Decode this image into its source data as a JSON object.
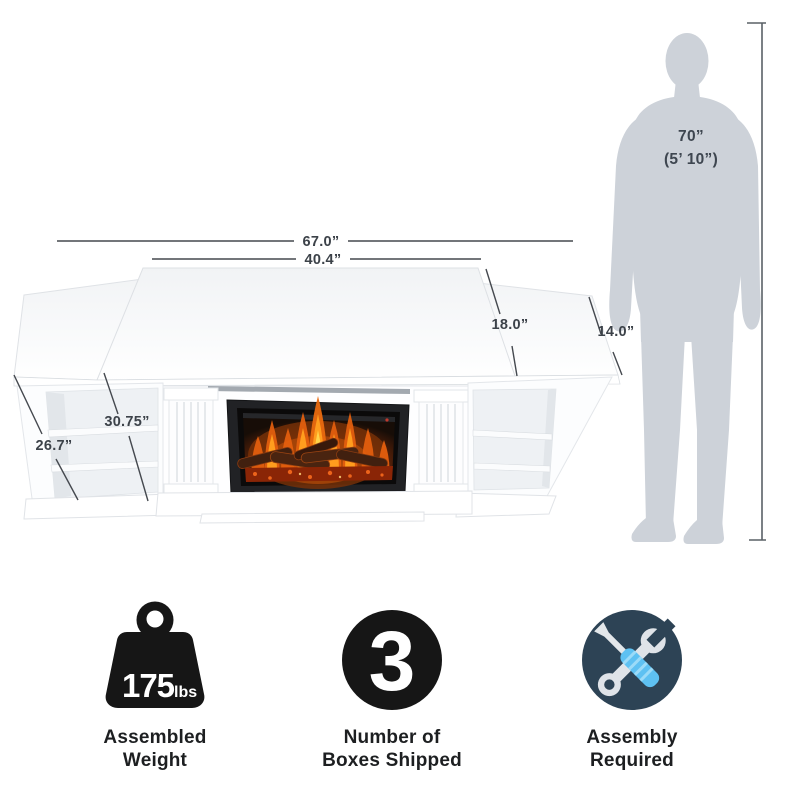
{
  "page": {
    "background": "#ffffff"
  },
  "diagram": {
    "dimensions": {
      "overall_width": "67.0”",
      "center_width": "40.4”",
      "center_depth": "18.0”",
      "side_depth": "14.0”",
      "interior_height": "30.75”",
      "side_height": "26.7”"
    },
    "person": {
      "height_in": "70”",
      "height_ft": "(5’ 10”)"
    }
  },
  "features": [
    {
      "icon": "weight-icon",
      "value": "175",
      "unit": "lbs",
      "label1": "Assembled",
      "label2": "Weight"
    },
    {
      "icon": "boxes-count-icon",
      "value": "3",
      "label1": "Number of",
      "label2": "Boxes Shipped"
    },
    {
      "icon": "assembly-tools-icon",
      "label1": "Assembly",
      "label2": "Required"
    }
  ],
  "colors": {
    "dimension_line": "#45494f",
    "silhouette": "#cdd2d9",
    "icon_black": "#161616",
    "assembly_navy": "#2d4355",
    "screwdriver_blue": "#5ec1f2",
    "tool_gray": "#dfe3e8",
    "flame_orange": "#ff8c12"
  }
}
